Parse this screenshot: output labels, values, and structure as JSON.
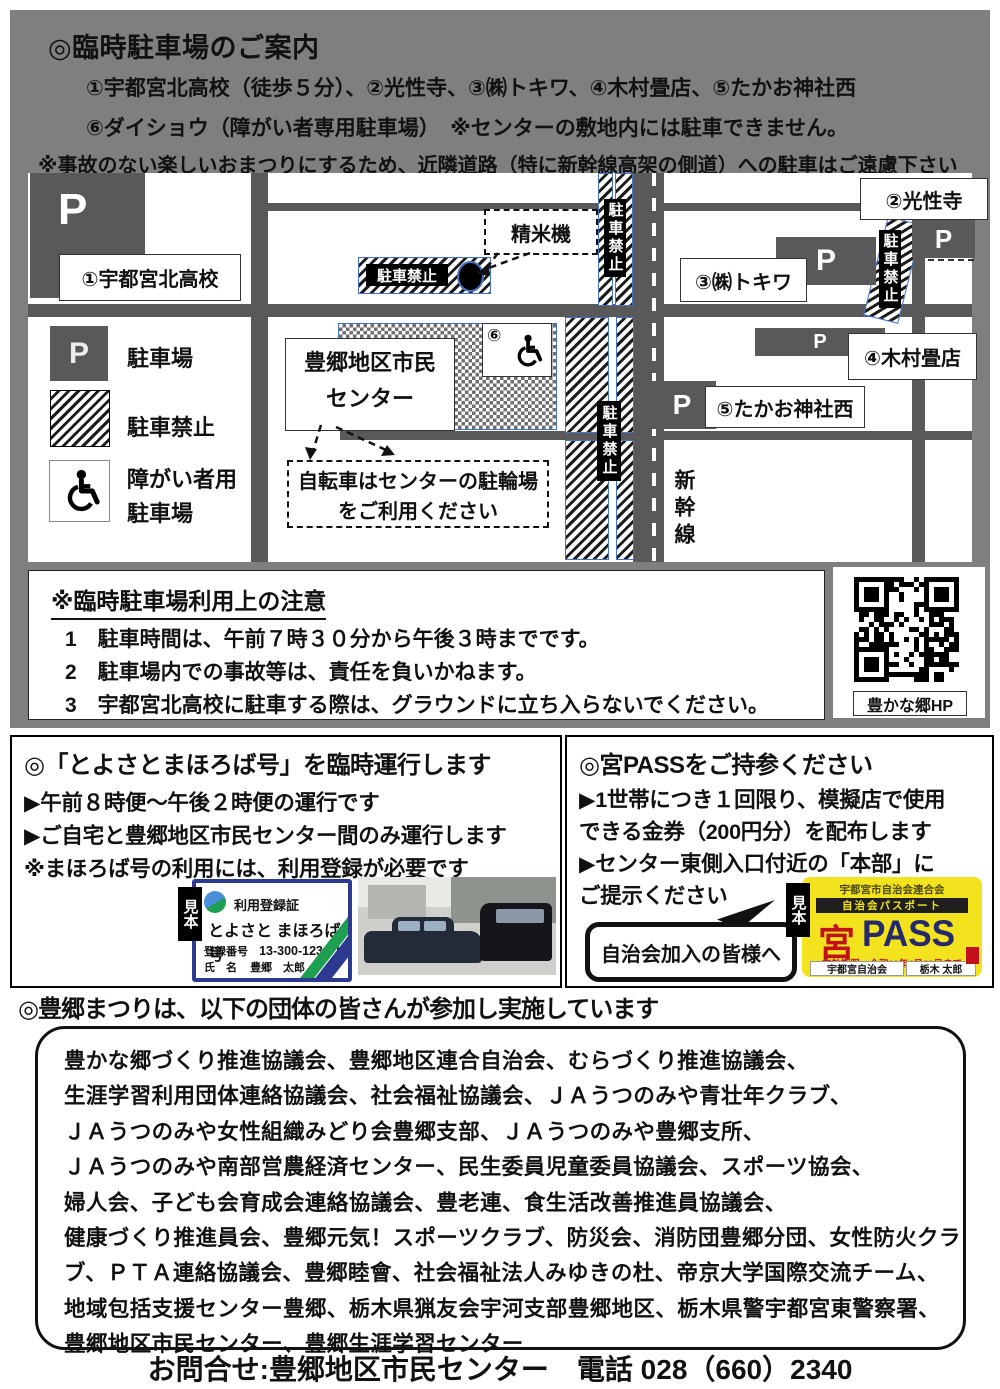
{
  "header": {
    "title": "◎臨時駐車場のご案内",
    "line1": "①宇都宮北高校（徒歩５分）、②光性寺、③㈱トキワ、④木村畳店、⑤たかお神社西",
    "line2": "⑥ダイショウ（障がい者専用駐車場）　※センターの敷地内には駐車できません。",
    "caution": "※事故のない楽しいおまつりにするため、近隣道路（特に新幹線高架の側道）への駐車はご遠慮下さい"
  },
  "map": {
    "p": "P",
    "no_parking": "駐車禁止",
    "sites": {
      "school": "①宇都宮北高校",
      "temple": "②光性寺",
      "tokiwa": "③㈱トキワ",
      "tatami": "④木村畳店",
      "shrine": "⑤たかお神社西"
    },
    "center_line1": "豊郷地区市民",
    "center_line2": "センター",
    "rice_mill": "精米機",
    "six": "⑥",
    "shinkansen": "新幹線",
    "bike_line1": "自転車はセンターの駐輪場",
    "bike_line2": "をご利用ください",
    "legend": {
      "parking": "駐車場",
      "no_parking": "駐車禁止",
      "disabled_line1": "障がい者用",
      "disabled_line2": "駐車場"
    }
  },
  "notes": {
    "title": "※臨時駐車場利用上の注意",
    "items": [
      "1　駐車時間は、午前７時３０分から午後３時までです。",
      "2　駐車場内での事故等は、責任を負いかねます。",
      "3　宇都宮北高校に駐車する際は、グラウンドに立ち入らないでください。"
    ]
  },
  "qr": {
    "caption": "豊かな郷HP"
  },
  "mahoroba": {
    "title": "◎「とよさとまほろば号」を臨時運行します",
    "lines": [
      "▶午前８時便～午後２時便の運行です",
      "▶ご自宅と豊郷地区市民センター間のみ運行します",
      "※まほろば号の利用には、利用登録が必要です"
    ],
    "card": {
      "sample": "見本",
      "heading": "利用登録証",
      "name": "とよさと まほろば号",
      "reg_label": "登録番号",
      "reg_no": "13-300-123-01",
      "holder_label": "氏　名",
      "holder": "豊郷　太郎"
    }
  },
  "miyapass": {
    "title": "◎宮PASSをご持参ください",
    "lines": [
      "▶1世帯につき１回限り、模擬店で使用",
      "できる金券（200円分）を配布します",
      "▶センター東側入口付近の「本部」に",
      "ご提示ください"
    ],
    "bubble": "自治会加入の皆様へ",
    "card": {
      "sample": "見本",
      "org": "宇都宮市自治会連合会",
      "passport": "自治会パスポート",
      "miya": "宮",
      "pass": "PASS",
      "expiry": "有効期限　令和11年4月30日まで",
      "holder_left": "宇都宮自治会",
      "holder_right": "栃木 太郎"
    }
  },
  "participants": {
    "heading": "◎豊郷まつりは、以下の団体の皆さんが参加し実施しています",
    "lines": [
      "豊かな郷づくり推進協議会、豊郷地区連合自治会、むらづくり推進協議会、",
      "生涯学習利用団体連絡協議会、社会福祉協議会、ＪＡうつのみや青壮年クラブ、",
      "ＪＡうつのみや女性組織みどり会豊郷支部、ＪＡうつのみや豊郷支所、",
      "ＪＡうつのみや南部営農経済センター、民生委員児童委員協議会、スポーツ協会、",
      "婦人会、子ども会育成会連絡協議会、豊老連、食生活改善推進員協議会、",
      "健康づくり推進員会、豊郷元気！スポーツクラブ、防災会、消防団豊郷分団、女性防火クラ",
      "ブ、ＰＴＡ連絡協議会、豊郷睦會、社会福祉法人みゆきの杜、帝京大学国際交流チーム、",
      "地域包括支援センター豊郷、栃木県猟友会宇河支部豊郷地区、栃木県警宇都宮東警察署、",
      "豊郷地区市民センター、豊郷生涯学習センター"
    ]
  },
  "footer": {
    "contact": "お問合せ:豊郷地区市民センター　電話 028（660）2340"
  }
}
